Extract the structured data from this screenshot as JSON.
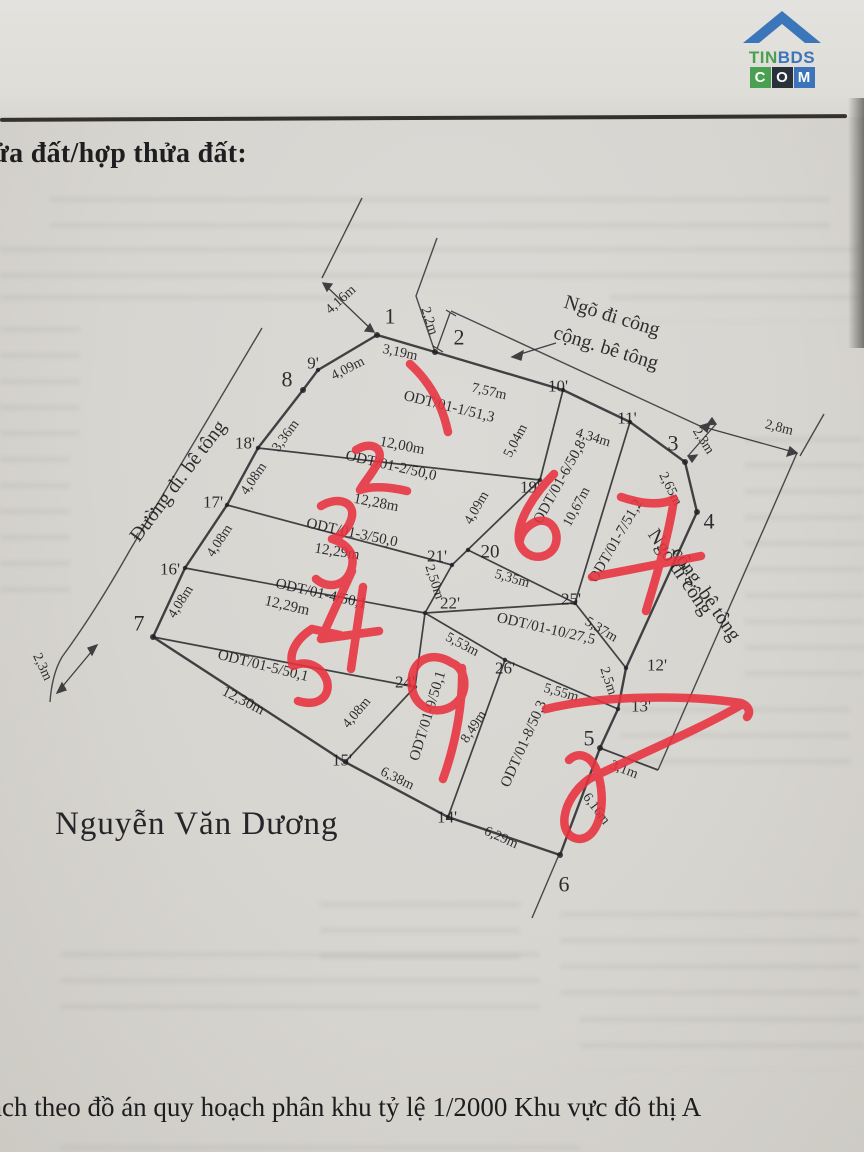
{
  "header": {
    "title": "ửa đất/hợp thửa đất:"
  },
  "owner_name": "Nguyễn Văn Dương",
  "footer": {
    "line": "ạch theo đồ án quy hoạch phân khu tỷ lệ 1/2000 Khu vực đô thị A"
  },
  "logo": {
    "tin": "TIN",
    "bds": "BDS",
    "c": "C",
    "o": "O",
    "m": "M"
  },
  "colors": {
    "paper": "#d9d7d3",
    "ink": "#1c1c1e",
    "red_pen": "#e8323f",
    "logo_green": "#3f9c47",
    "logo_blue": "#2f6db8",
    "logo_dark": "#1c2430"
  },
  "diagram": {
    "labels": [
      {
        "t": "1",
        "x": 390,
        "y": 316,
        "s": 22,
        "n": "vertex-label"
      },
      {
        "t": "2",
        "x": 459,
        "y": 337,
        "s": 22,
        "n": "vertex-label"
      },
      {
        "t": "3",
        "x": 673,
        "y": 443,
        "s": 22,
        "n": "vertex-label"
      },
      {
        "t": "4",
        "x": 709,
        "y": 521,
        "s": 22,
        "n": "vertex-label"
      },
      {
        "t": "5",
        "x": 589,
        "y": 738,
        "s": 22,
        "n": "vertex-label"
      },
      {
        "t": "6",
        "x": 564,
        "y": 884,
        "s": 22,
        "n": "vertex-label"
      },
      {
        "t": "7",
        "x": 139,
        "y": 623,
        "s": 22,
        "n": "vertex-label"
      },
      {
        "t": "8",
        "x": 287,
        "y": 379,
        "s": 22,
        "n": "vertex-label"
      },
      {
        "t": "9'",
        "x": 313,
        "y": 363,
        "s": 17,
        "n": "vertex-label"
      },
      {
        "t": "10'",
        "x": 558,
        "y": 386,
        "s": 17,
        "n": "vertex-label"
      },
      {
        "t": "11'",
        "x": 627,
        "y": 418,
        "s": 17,
        "n": "vertex-label"
      },
      {
        "t": "12'",
        "x": 657,
        "y": 665,
        "s": 17,
        "n": "vertex-label"
      },
      {
        "t": "13'",
        "x": 641,
        "y": 706,
        "s": 17,
        "n": "vertex-label"
      },
      {
        "t": "14'",
        "x": 447,
        "y": 817,
        "s": 17,
        "n": "vertex-label"
      },
      {
        "t": "15'",
        "x": 342,
        "y": 760,
        "s": 17,
        "n": "vertex-label"
      },
      {
        "t": "16'",
        "x": 170,
        "y": 569,
        "s": 17,
        "n": "vertex-label"
      },
      {
        "t": "17'",
        "x": 213,
        "y": 502,
        "s": 17,
        "n": "vertex-label"
      },
      {
        "t": "18'",
        "x": 245,
        "y": 443,
        "s": 17,
        "n": "vertex-label"
      },
      {
        "t": "19'",
        "x": 530,
        "y": 487,
        "s": 17,
        "n": "vertex-label"
      },
      {
        "t": "20",
        "x": 490,
        "y": 552,
        "s": 19,
        "n": "vertex-label"
      },
      {
        "t": "21'",
        "x": 437,
        "y": 556,
        "s": 17,
        "n": "vertex-label"
      },
      {
        "t": "22'",
        "x": 450,
        "y": 603,
        "s": 17,
        "n": "vertex-label"
      },
      {
        "t": "24'",
        "x": 405,
        "y": 682,
        "s": 17,
        "n": "vertex-label"
      },
      {
        "t": "25'",
        "x": 571,
        "y": 599,
        "s": 17,
        "n": "vertex-label"
      },
      {
        "t": "26'",
        "x": 505,
        "y": 668,
        "s": 17,
        "n": "vertex-label"
      },
      {
        "t": "4,16m",
        "x": 341,
        "y": 300,
        "r": -42,
        "n": "measurement-label"
      },
      {
        "t": "3,19m",
        "x": 400,
        "y": 353,
        "r": 12,
        "n": "measurement-label"
      },
      {
        "t": "2,2m",
        "x": 429,
        "y": 321,
        "r": 72,
        "n": "measurement-label"
      },
      {
        "t": "7,57m",
        "x": 489,
        "y": 392,
        "r": 13,
        "n": "measurement-label"
      },
      {
        "t": "4,34m",
        "x": 593,
        "y": 438,
        "r": 17,
        "n": "measurement-label"
      },
      {
        "t": "2,8m",
        "x": 779,
        "y": 428,
        "r": 14,
        "n": "measurement-label"
      },
      {
        "t": "2,3m",
        "x": 703,
        "y": 441,
        "r": 58,
        "n": "measurement-label"
      },
      {
        "t": "2,65m",
        "x": 670,
        "y": 489,
        "r": 63,
        "n": "measurement-label"
      },
      {
        "t": "4,09m",
        "x": 348,
        "y": 369,
        "r": -27,
        "n": "measurement-label"
      },
      {
        "t": "3,36m",
        "x": 286,
        "y": 436,
        "r": -54,
        "n": "measurement-label"
      },
      {
        "t": "4,08m",
        "x": 254,
        "y": 479,
        "r": -56,
        "n": "measurement-label"
      },
      {
        "t": "4,08m",
        "x": 220,
        "y": 541,
        "r": -57,
        "n": "measurement-label"
      },
      {
        "t": "4,08m",
        "x": 181,
        "y": 602,
        "r": -58,
        "n": "measurement-label"
      },
      {
        "t": "4,08m",
        "x": 357,
        "y": 713,
        "r": -50,
        "n": "measurement-label"
      },
      {
        "t": "12,00m",
        "x": 402,
        "y": 446,
        "r": 11,
        "s": 15,
        "n": "measurement-label"
      },
      {
        "t": "12,28m",
        "x": 376,
        "y": 503,
        "r": 11,
        "s": 15,
        "n": "measurement-label"
      },
      {
        "t": "12,29m",
        "x": 337,
        "y": 552,
        "r": 9,
        "s": 15,
        "n": "measurement-label"
      },
      {
        "t": "12,29m",
        "x": 287,
        "y": 606,
        "r": 13,
        "s": 15,
        "n": "measurement-label"
      },
      {
        "t": "12,30m",
        "x": 243,
        "y": 701,
        "r": 27,
        "s": 15,
        "n": "measurement-label"
      },
      {
        "t": "5,04m",
        "x": 516,
        "y": 441,
        "r": -62,
        "n": "measurement-label"
      },
      {
        "t": "4,09m",
        "x": 477,
        "y": 508,
        "r": -60,
        "n": "measurement-label"
      },
      {
        "t": "10,67m",
        "x": 577,
        "y": 507,
        "r": -62,
        "n": "measurement-label"
      },
      {
        "t": "2,50m",
        "x": 434,
        "y": 582,
        "r": 72,
        "n": "measurement-label"
      },
      {
        "t": "5,35m",
        "x": 512,
        "y": 579,
        "r": 16,
        "n": "measurement-label"
      },
      {
        "t": "5,37m",
        "x": 601,
        "y": 630,
        "r": 31,
        "n": "measurement-label"
      },
      {
        "t": "2,5m",
        "x": 608,
        "y": 681,
        "r": 72,
        "n": "measurement-label"
      },
      {
        "t": "5,53m",
        "x": 462,
        "y": 645,
        "r": 28,
        "n": "measurement-label"
      },
      {
        "t": "5,55m",
        "x": 561,
        "y": 693,
        "r": 16,
        "n": "measurement-label"
      },
      {
        "t": "8,49m",
        "x": 474,
        "y": 727,
        "r": -57,
        "n": "measurement-label"
      },
      {
        "t": "3,1m",
        "x": 624,
        "y": 770,
        "r": 21,
        "n": "measurement-label"
      },
      {
        "t": "6,16m",
        "x": 596,
        "y": 809,
        "r": 53,
        "n": "measurement-label"
      },
      {
        "t": "6,29m",
        "x": 501,
        "y": 838,
        "r": 24,
        "n": "measurement-label"
      },
      {
        "t": "6,38m",
        "x": 397,
        "y": 779,
        "r": 26,
        "n": "measurement-label"
      },
      {
        "t": "2,3m",
        "x": 42,
        "y": 667,
        "r": 65,
        "n": "measurement-label"
      },
      {
        "t": "ODT/01-1/51,3",
        "x": 449,
        "y": 407,
        "r": 14,
        "s": 15,
        "n": "plot-label"
      },
      {
        "t": "ODT/01-2/50,0",
        "x": 391,
        "y": 466,
        "r": 13,
        "s": 15,
        "n": "plot-label"
      },
      {
        "t": "ODT/01-3/50,0",
        "x": 352,
        "y": 533,
        "r": 12,
        "s": 15,
        "n": "plot-label"
      },
      {
        "t": "ODT/01-4/50,1",
        "x": 321,
        "y": 594,
        "r": 13,
        "s": 15,
        "n": "plot-label"
      },
      {
        "t": "ODT/01-5/50,1",
        "x": 263,
        "y": 666,
        "r": 14,
        "s": 15,
        "n": "plot-label"
      },
      {
        "t": "ODT/01-6/50,8",
        "x": 560,
        "y": 482,
        "r": -61,
        "s": 15,
        "n": "plot-label"
      },
      {
        "t": "ODT/01-7/51,2",
        "x": 616,
        "y": 541,
        "r": -60,
        "s": 15,
        "n": "plot-label"
      },
      {
        "t": "ODT/01-10/27,5",
        "x": 546,
        "y": 629,
        "r": 13,
        "s": 15,
        "n": "plot-label"
      },
      {
        "t": "ODT/01-9/50,1",
        "x": 428,
        "y": 716,
        "r": -73,
        "s": 15,
        "n": "plot-label"
      },
      {
        "t": "ODT/01-8/50,3",
        "x": 524,
        "y": 744,
        "r": -66,
        "s": 15,
        "n": "plot-label"
      },
      {
        "t": "Ngõ đi công",
        "x": 612,
        "y": 316,
        "r": 17,
        "s": 20,
        "n": "road-label"
      },
      {
        "t": "cộng. bê tông",
        "x": 606,
        "y": 348,
        "r": 17,
        "s": 20,
        "n": "road-label"
      },
      {
        "t": "Đường đi. bê tông",
        "x": 178,
        "y": 481,
        "r": -53,
        "s": 20,
        "n": "road-label"
      },
      {
        "t": "Ngõ đi công",
        "x": 680,
        "y": 572,
        "r": 56,
        "s": 20,
        "n": "road-label"
      },
      {
        "t": "cộng. bê tông",
        "x": 706,
        "y": 594,
        "r": 56,
        "s": 20,
        "n": "road-label"
      }
    ],
    "red_annotations": [
      {
        "digit": "1",
        "marks_plot": "ODT/01-1/51,3"
      },
      {
        "digit": "2",
        "marks_plot": "ODT/01-2/50,0"
      },
      {
        "digit": "3",
        "marks_plot": "ODT/01-3/50,0"
      },
      {
        "digit": "4",
        "marks_plot": "ODT/01-4/50,1"
      },
      {
        "digit": "5",
        "marks_plot": "ODT/01-5/50,1"
      },
      {
        "digit": "6",
        "marks_plot": "ODT/01-6/50,8"
      },
      {
        "digit": "7",
        "marks_plot": "ODT/01-7/51,2"
      },
      {
        "digit": "8",
        "marks_plot": "ODT/01-8/50,3"
      },
      {
        "digit": "9",
        "marks_plot": "ODT/01-9/50,1"
      }
    ]
  }
}
